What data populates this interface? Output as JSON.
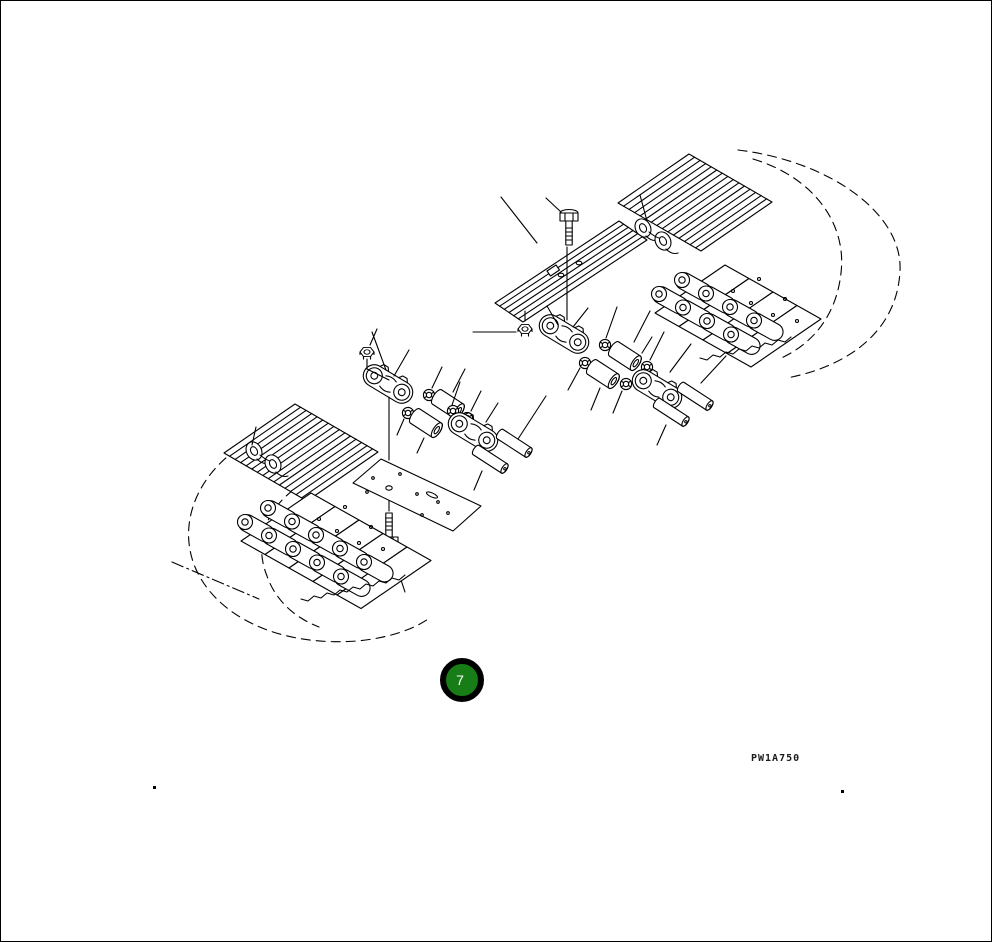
{
  "page": {
    "background": "#ffffff",
    "border_color": "#000000",
    "line_color": "#000000"
  },
  "callout": {
    "number": "7",
    "fill_color": "#177d17",
    "ring_color": "#000000",
    "text_color": "#ffffff"
  },
  "drawing_code": "PW1A750",
  "diagram": {
    "components": [
      "track-shoe-band-upper-right",
      "track-loop-outline-upper-right",
      "track-link-chain-upper-right",
      "shoe-clamp-links-upper-right",
      "single-track-shoe",
      "shoe-bolt-upper",
      "shoe-nut",
      "master-link-kit-right",
      "master-link-kit-left",
      "seal-rings",
      "bushings",
      "track-pins",
      "track-shoe-plate-inner-face",
      "shoe-bolt-lower",
      "track-shoe-band-lower-left",
      "track-loop-outline-lower-left",
      "track-link-chain-lower-left",
      "shoe-clamp-links-lower-left"
    ]
  }
}
